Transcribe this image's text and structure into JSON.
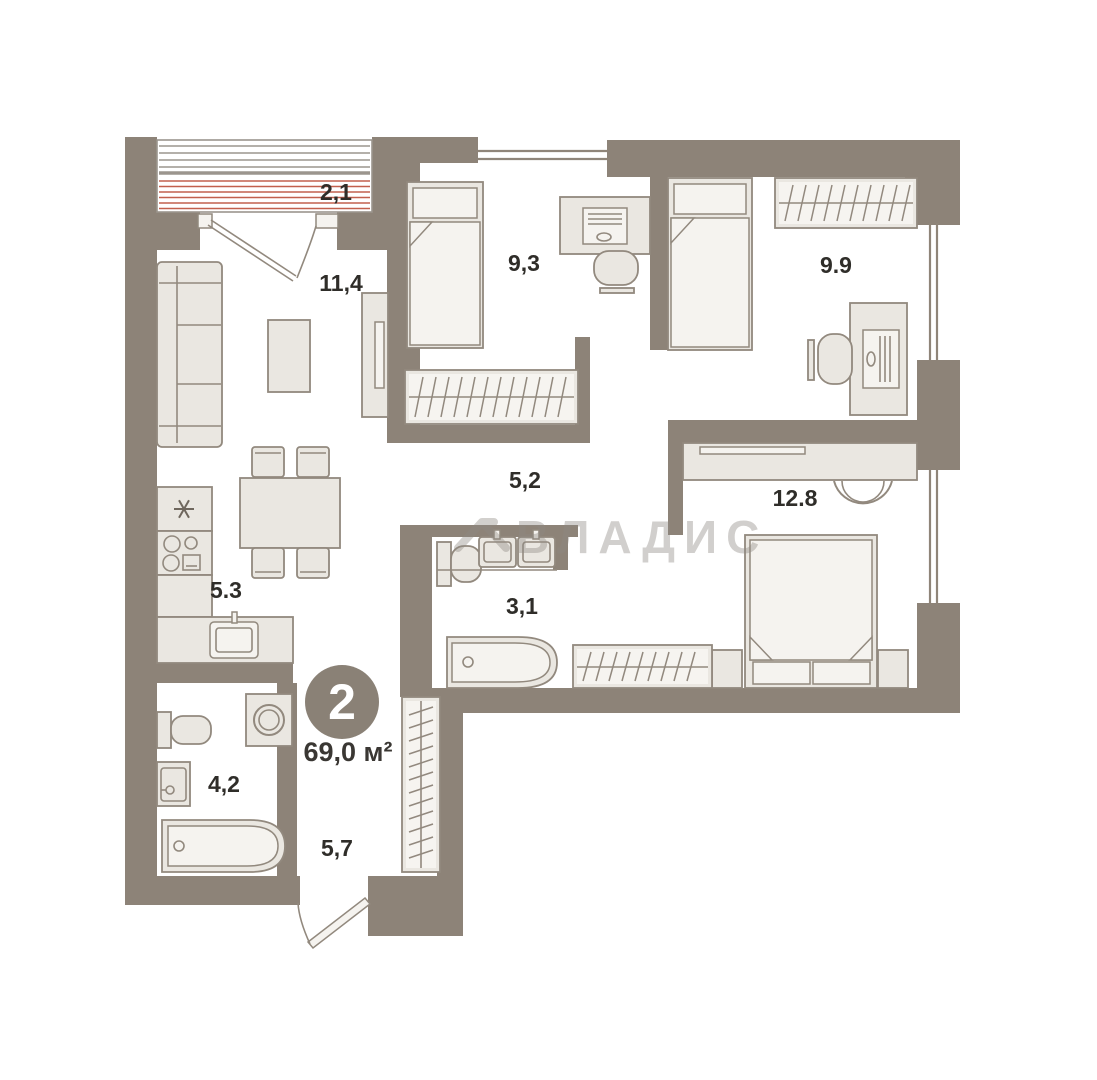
{
  "plan": {
    "badge": {
      "rooms": "2",
      "area": "69,0 м²"
    },
    "watermark": "ВЛАДИС",
    "rooms": {
      "balcony": {
        "label": "2,1"
      },
      "living": {
        "label": "11,4"
      },
      "bedroom1": {
        "label": "9,3"
      },
      "bedroom2": {
        "label": "9.9"
      },
      "hall": {
        "label": "5,2"
      },
      "bedroom3": {
        "label": "12.8"
      },
      "kitchen": {
        "label": "5.3"
      },
      "bathroom1": {
        "label": "3,1"
      },
      "bathroom2": {
        "label": "4,2"
      },
      "entry": {
        "label": "5,7"
      }
    },
    "colors": {
      "wall": "#8d8378",
      "furniture_fill": "#eae7e1",
      "furniture_stroke": "#92897e",
      "balcony_stripe_gray": "#9b958d",
      "balcony_stripe_red": "#c2604e",
      "label_text": "#2f2d29",
      "badge_fill": "#8a8176",
      "watermark": "#8f8a83"
    }
  }
}
